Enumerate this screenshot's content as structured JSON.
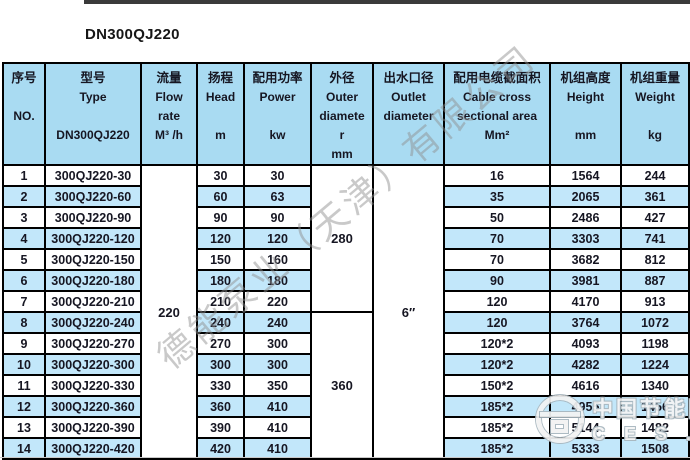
{
  "title": "DN300QJ220",
  "colors": {
    "header_bg": "#a9dbf2",
    "stripe_bg": "#c2e7fa",
    "border": "#000000",
    "topbar": "#3a3a3a"
  },
  "table": {
    "headers": {
      "no": [
        "序号",
        "",
        "NO.",
        "",
        ""
      ],
      "type": [
        "型号",
        "Type",
        "",
        "DN300QJ220",
        ""
      ],
      "flow": [
        "流量",
        "Flow",
        "rate",
        "M³ /h",
        ""
      ],
      "head": [
        "扬程",
        "Head",
        "",
        "m",
        ""
      ],
      "power": [
        "配用功率",
        "Power",
        "",
        "kw",
        ""
      ],
      "outer": [
        "外径",
        "Outer",
        "diamete",
        "r",
        "mm"
      ],
      "outlet": [
        "出水口径",
        "Outlet",
        "diameter",
        "",
        ""
      ],
      "cable": [
        "配用电缆截面积",
        "Cable cross",
        "sectional area",
        "Mm²",
        ""
      ],
      "height": [
        "机组高度",
        "Height",
        "",
        "mm",
        ""
      ],
      "weight": [
        "机组重量",
        "Weight",
        "",
        "kg",
        ""
      ]
    },
    "merged": {
      "flow_rate": "220",
      "outer_diameter_rows_1_7": "280",
      "outer_diameter_rows_8_14": "360",
      "outlet_diameter": "6″"
    },
    "rows": [
      {
        "no": "1",
        "type": "300QJ220-30",
        "head": "30",
        "power": "30",
        "cable": "16",
        "height": "1564",
        "weight": "244"
      },
      {
        "no": "2",
        "type": "300QJ220-60",
        "head": "60",
        "power": "63",
        "cable": "35",
        "height": "2065",
        "weight": "361"
      },
      {
        "no": "3",
        "type": "300QJ220-90",
        "head": "90",
        "power": "90",
        "cable": "50",
        "height": "2486",
        "weight": "427"
      },
      {
        "no": "4",
        "type": "300QJ220-120",
        "head": "120",
        "power": "120",
        "cable": "70",
        "height": "3303",
        "weight": "741"
      },
      {
        "no": "5",
        "type": "300QJ220-150",
        "head": "150",
        "power": "160",
        "cable": "70",
        "height": "3682",
        "weight": "812"
      },
      {
        "no": "6",
        "type": "300QJ220-180",
        "head": "180",
        "power": "180",
        "cable": "90",
        "height": "3981",
        "weight": "887"
      },
      {
        "no": "7",
        "type": "300QJ220-210",
        "head": "210",
        "power": "220",
        "cable": "120",
        "height": "4170",
        "weight": "913"
      },
      {
        "no": "8",
        "type": "300QJ220-240",
        "head": "240",
        "power": "240",
        "cable": "120",
        "height": "3764",
        "weight": "1072"
      },
      {
        "no": "9",
        "type": "300QJ220-270",
        "head": "270",
        "power": "300",
        "cable": "120*2",
        "height": "4093",
        "weight": "1198"
      },
      {
        "no": "10",
        "type": "300QJ220-300",
        "head": "300",
        "power": "300",
        "cable": "120*2",
        "height": "4282",
        "weight": "1224"
      },
      {
        "no": "11",
        "type": "300QJ220-330",
        "head": "330",
        "power": "350",
        "cable": "150*2",
        "height": "4616",
        "weight": "1340"
      },
      {
        "no": "12",
        "type": "300QJ220-360",
        "head": "360",
        "power": "410",
        "cable": "185*2",
        "height": "4955",
        "weight": "1456"
      },
      {
        "no": "13",
        "type": "300QJ220-390",
        "head": "390",
        "power": "410",
        "cable": "185*2",
        "height": "5144",
        "weight": "1482"
      },
      {
        "no": "14",
        "type": "300QJ220-420",
        "head": "420",
        "power": "410",
        "cable": "185*2",
        "height": "5333",
        "weight": "1508"
      }
    ]
  },
  "watermarks": {
    "diagonal": "德能泵业（天津）有限公司",
    "corner_line1": "中国节能网",
    "corner_line2": "C E S . C N"
  }
}
